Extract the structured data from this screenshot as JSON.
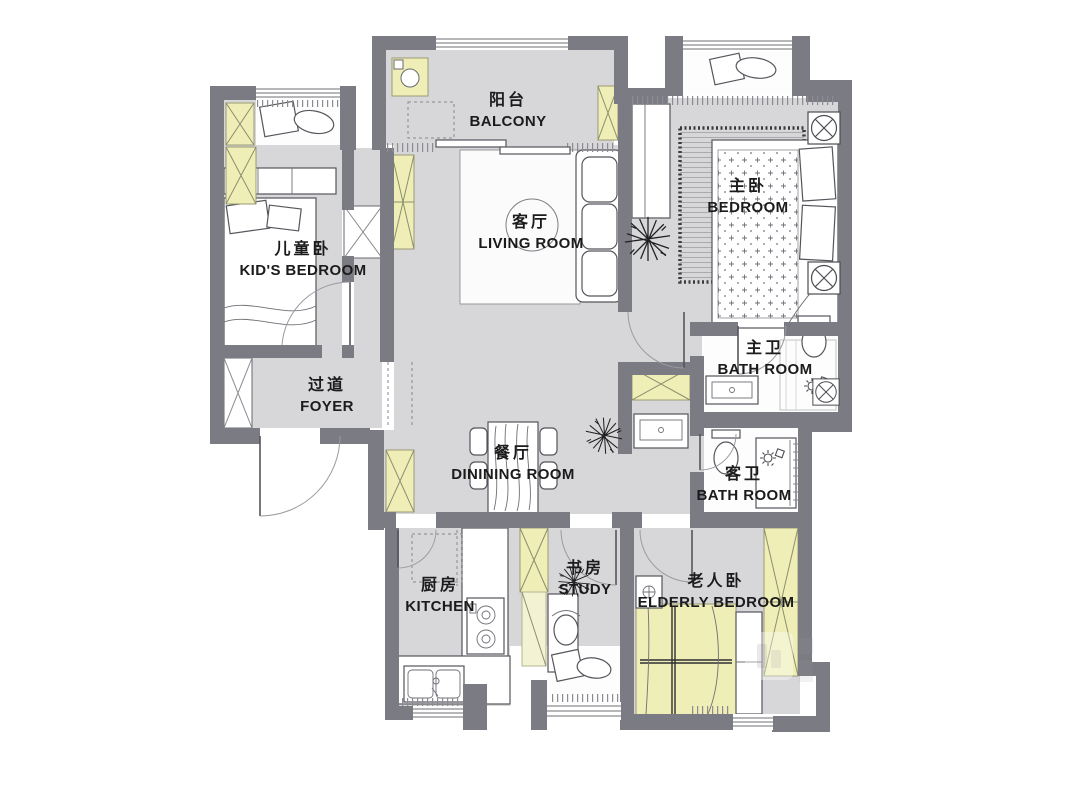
{
  "plan": {
    "rooms": [
      {
        "id": "balcony",
        "zh": "阳台",
        "en": "BALCONY"
      },
      {
        "id": "living-room",
        "zh": "客厅",
        "en": "LIVING ROOM"
      },
      {
        "id": "master-bedroom",
        "zh": "主卧",
        "en": "BEDROOM"
      },
      {
        "id": "kids-bedroom",
        "zh": "儿童卧",
        "en": "KID'S BEDROOM"
      },
      {
        "id": "foyer",
        "zh": "过道",
        "en": "FOYER"
      },
      {
        "id": "master-bath",
        "zh": "主卫",
        "en": "BATH ROOM"
      },
      {
        "id": "dining-room",
        "zh": "餐厅",
        "en": "DININING ROOM"
      },
      {
        "id": "guest-bath",
        "zh": "客卫",
        "en": "BATH ROOM"
      },
      {
        "id": "kitchen",
        "zh": "厨房",
        "en": "KITCHEN"
      },
      {
        "id": "study",
        "zh": "书房",
        "en": "STUDY"
      },
      {
        "id": "elderly-bedroom",
        "zh": "老人卧",
        "en": "ELDERLY BEDROOM"
      }
    ],
    "colors": {
      "wall": "#7b7b83",
      "floor": "#d7d7d9",
      "accent": "#eeeeb6",
      "accent_soft": "#f3f3d3",
      "outline": "#55555c",
      "label": "#1b1b1b"
    }
  }
}
